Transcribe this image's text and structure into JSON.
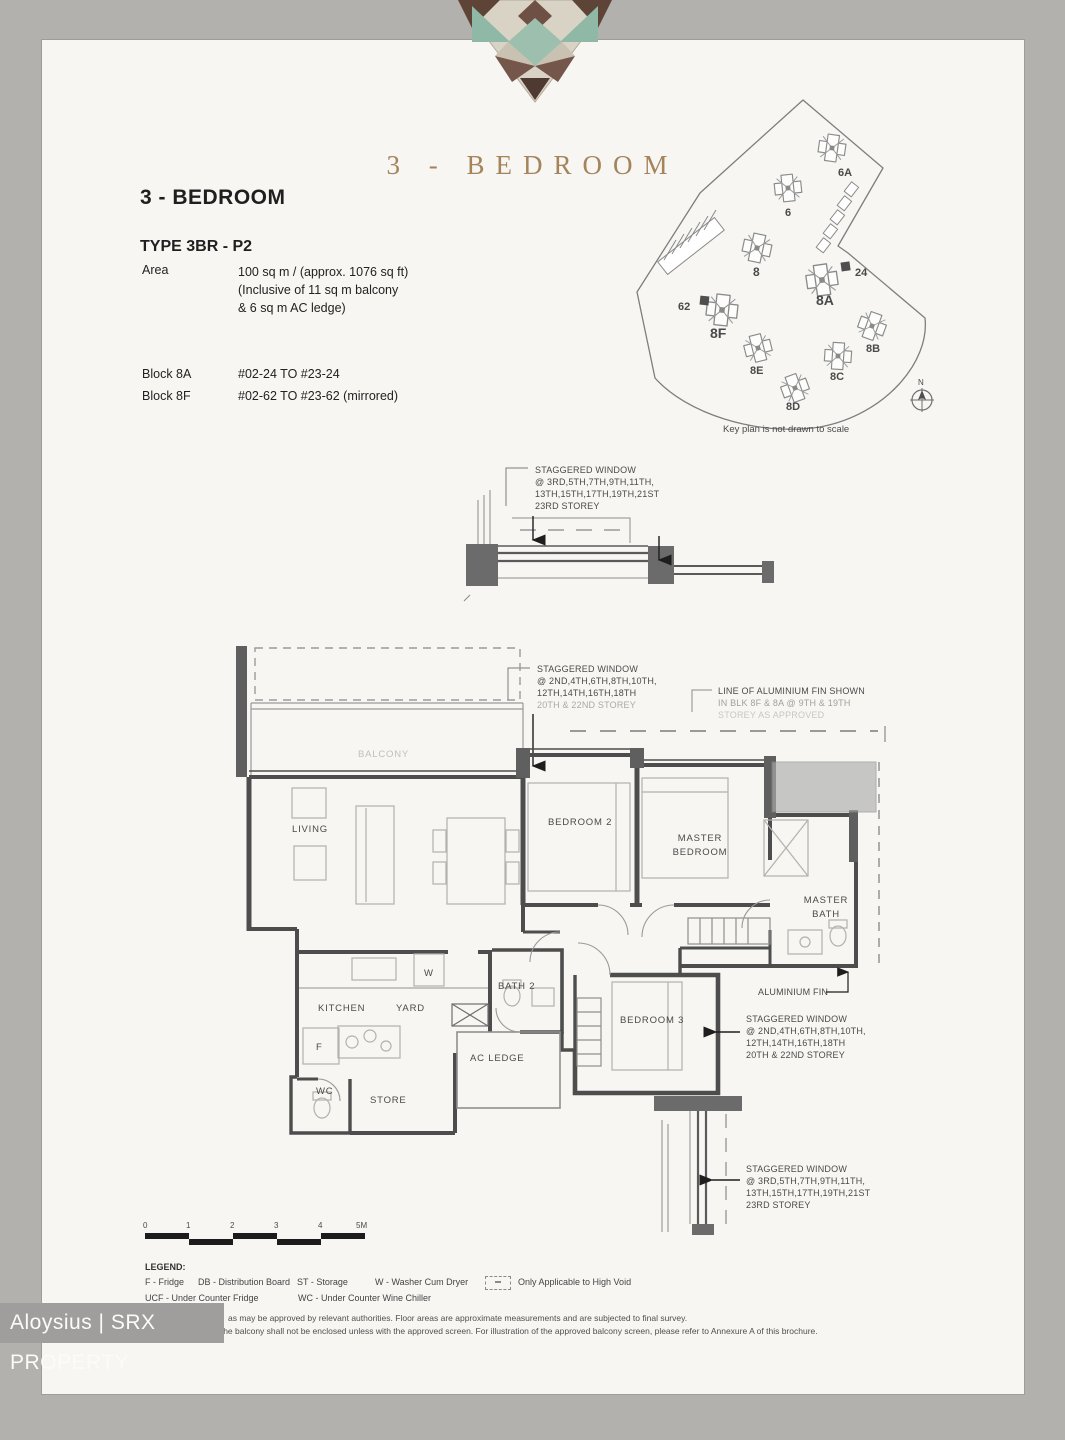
{
  "header": {
    "brand_title": "3 - BEDROOM",
    "unit_title": "3 - BEDROOM",
    "type_label": "TYPE 3BR - P2",
    "area_label": "Area",
    "area_lines": [
      "100 sq m / (approx. 1076 sq ft)",
      "(Inclusive of 11 sq m balcony",
      "& 6 sq m AC ledge)"
    ],
    "blocks": [
      {
        "name": "Block 8A",
        "range": "#02-24 TO #23-24"
      },
      {
        "name": "Block 8F",
        "range": "#02-62 TO #23-62 (mirrored)"
      }
    ]
  },
  "key_plan": {
    "caption": "Key plan is not drawn to scale",
    "north_label": "N",
    "labels": [
      "6A",
      "6",
      "8",
      "8A",
      "24",
      "62",
      "8F",
      "8B",
      "8E",
      "8C",
      "8D"
    ]
  },
  "annotations": {
    "staggered_top": [
      "STAGGERED WINDOW",
      "@ 3RD,5TH,7TH,9TH,11TH,",
      "13TH,15TH,17TH,19TH,21ST",
      "23RD STOREY"
    ],
    "staggered_mid": [
      "STAGGERED WINDOW",
      "@ 2ND,4TH,6TH,8TH,10TH,",
      "12TH,14TH,16TH,18TH",
      "20TH & 22ND STOREY"
    ],
    "alum_fin_line": [
      "LINE OF ALUMINIUM FIN SHOWN",
      "IN BLK 8F & 8A @ 9TH & 19TH",
      "STOREY AS APPROVED"
    ],
    "alum_fin_label": "ALUMINIUM FIN",
    "staggered_right": [
      "STAGGERED WINDOW",
      "@ 2ND,4TH,6TH,8TH,10TH,",
      "12TH,14TH,16TH,18TH",
      "20TH & 22ND STOREY"
    ],
    "staggered_bottom": [
      "STAGGERED WINDOW",
      "@ 3RD,5TH,7TH,9TH,11TH,",
      "13TH,15TH,17TH,19TH,21ST",
      "23RD STOREY"
    ]
  },
  "rooms": {
    "balcony": "BALCONY",
    "living": "LIVING",
    "bedroom2": "BEDROOM 2",
    "master1": "MASTER",
    "master2": "BEDROOM",
    "mbath1": "MASTER",
    "mbath2": "BATH",
    "kitchen": "KITCHEN",
    "yard": "YARD",
    "bath2": "BATH 2",
    "wc": "WC",
    "store": "STORE",
    "ac_ledge": "AC LEDGE",
    "bedroom3": "BEDROOM 3",
    "washer": "W",
    "fridge": "F"
  },
  "scale_bar": {
    "ticks": [
      "0",
      "1",
      "2",
      "3",
      "4",
      "5M"
    ]
  },
  "legend": {
    "title": "LEGEND:",
    "row1": [
      "F - Fridge",
      "DB - Distribution Board",
      "ST - Storage",
      "W - Washer Cum Dryer"
    ],
    "high_void": "Only Applicable to High Void",
    "row2": [
      "UCF - Under Counter Fridge",
      "WC - Under Counter Wine Chiller"
    ]
  },
  "disclaimer": {
    "line1": "as may be approved by relevant authorities. Floor areas are approximate measurements and are subjected to final survey.",
    "line2": "The balcony shall not be enclosed unless with the approved screen. For illustration of the approved balcony screen, please refer to Annexure A of this brochure."
  },
  "watermark": {
    "text": "Aloysius | SRX PROPERTY"
  }
}
